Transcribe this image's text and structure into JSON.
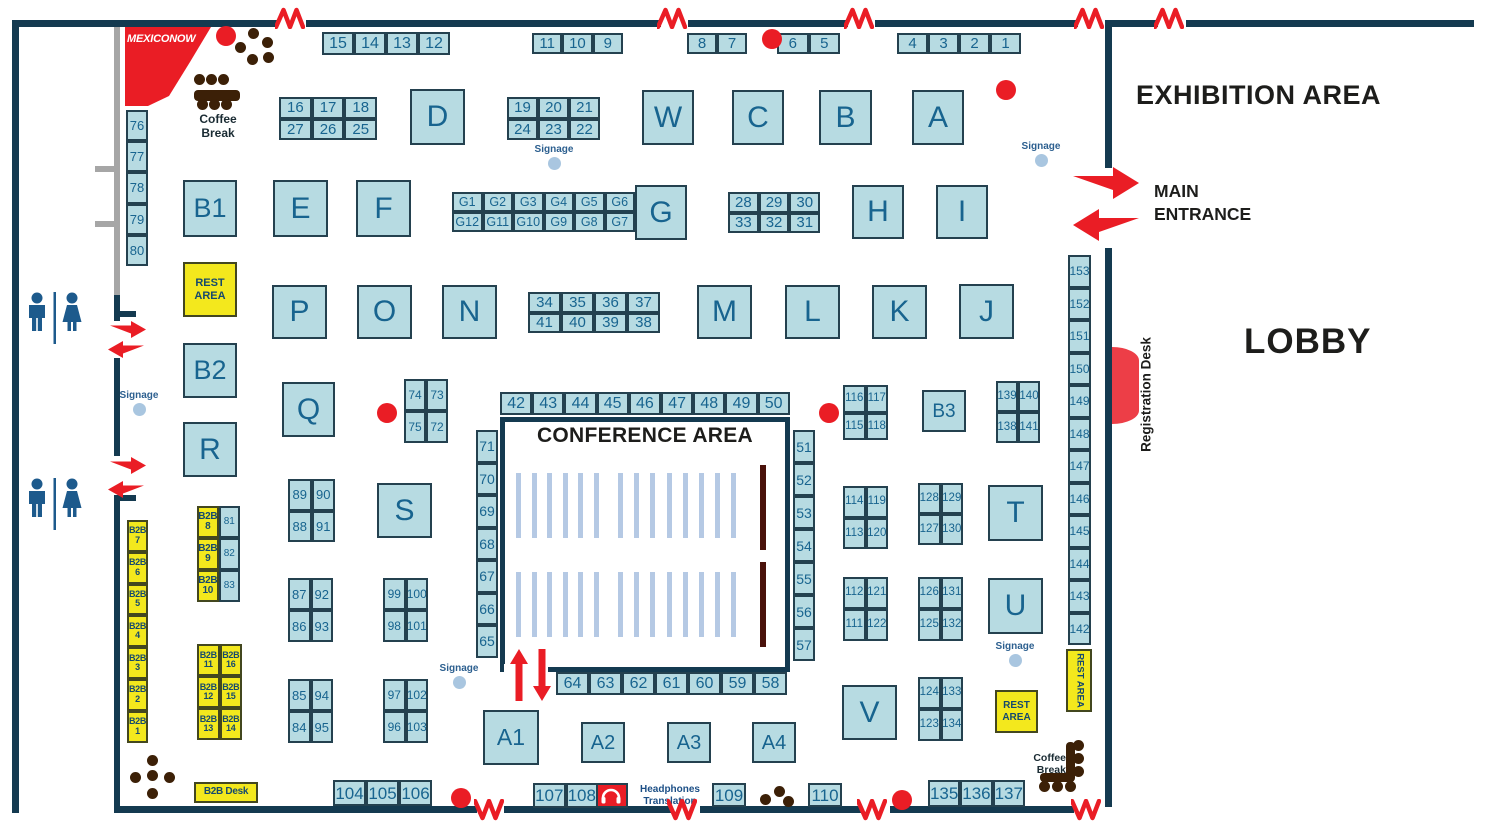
{
  "labels": {
    "logo": "MEXICONOW",
    "exhibition_area": "EXHIBITION AREA",
    "main_entrance": "MAIN\nENTRANCE",
    "lobby": "LOBBY",
    "conference_area": "CONFERENCE AREA",
    "registration_desk": "Registration Desk",
    "coffee_break": "Coffee\nBreak",
    "rest_area": "REST\nAREA",
    "rest_area_vertical": "REST AREA",
    "b2b_desk": "B2B Desk",
    "signage": "Signage",
    "headphones_translation": "Headphones\nTranslation"
  },
  "colors": {
    "booth_fill": "#b7dbe2",
    "booth_border": "#24414f",
    "booth_text": "#18648f",
    "yellow_fill": "#f3e81d",
    "wall": "#143a50",
    "red": "#ea1d25",
    "brown": "#3c2007",
    "seat": "#b5c9e4",
    "podium": "#4a120b",
    "signage_dot": "#a9c6e0",
    "gray": "#a6a6a6"
  },
  "booth_groups": {
    "strip_15_12": [
      "15",
      "14",
      "13",
      "12"
    ],
    "strip_11_9": [
      "11",
      "10",
      "9"
    ],
    "strip_8_7": [
      "8",
      "7"
    ],
    "strip_6_5": [
      "6",
      "5"
    ],
    "strip_4_1": [
      "4",
      "3",
      "2",
      "1"
    ],
    "block_16_25": [
      "16",
      "17",
      "18",
      "27",
      "26",
      "25"
    ],
    "block_19_22": [
      "19",
      "20",
      "21",
      "24",
      "23",
      "22"
    ],
    "block_g": [
      "G1",
      "G2",
      "G3",
      "G4",
      "G5",
      "G6",
      "G12",
      "G11",
      "G10",
      "G9",
      "G8",
      "G7"
    ],
    "block_28_31": [
      "28",
      "29",
      "30",
      "33",
      "32",
      "31"
    ],
    "block_34_38": [
      "34",
      "35",
      "36",
      "37",
      "41",
      "40",
      "39",
      "38"
    ],
    "col_76_80": [
      "76",
      "77",
      "78",
      "79",
      "80"
    ],
    "col_153_142": [
      "153",
      "152",
      "151",
      "150",
      "149",
      "148",
      "147",
      "146",
      "145",
      "144",
      "143",
      "142"
    ],
    "strip_42_50": [
      "42",
      "43",
      "44",
      "45",
      "46",
      "47",
      "48",
      "49",
      "50"
    ],
    "strip_64_58": [
      "64",
      "63",
      "62",
      "61",
      "60",
      "59",
      "58"
    ],
    "col_71_65": [
      "71",
      "70",
      "69",
      "68",
      "67",
      "66",
      "65"
    ],
    "col_51_57": [
      "51",
      "52",
      "53",
      "54",
      "55",
      "56",
      "57"
    ],
    "block_74_72": [
      "74",
      "73",
      "75",
      "72"
    ],
    "block_116_118": [
      "116",
      "117",
      "115",
      "118"
    ],
    "block_139_141": [
      "139",
      "140",
      "138",
      "141"
    ],
    "block_114_120": [
      "114",
      "119",
      "113",
      "120"
    ],
    "block_128_130": [
      "128",
      "129",
      "127",
      "130"
    ],
    "block_112_122": [
      "112",
      "121",
      "111",
      "122"
    ],
    "block_126_132": [
      "126",
      "131",
      "125",
      "132"
    ],
    "block_124_134": [
      "124",
      "133",
      "123",
      "134"
    ],
    "block_89_91": [
      "89",
      "90",
      "88",
      "91"
    ],
    "block_87_93": [
      "87",
      "92",
      "86",
      "93"
    ],
    "block_85_95": [
      "85",
      "94",
      "84",
      "95"
    ],
    "block_99_101": [
      "99",
      "100",
      "98",
      "101"
    ],
    "block_97_103": [
      "97",
      "102",
      "96",
      "103"
    ],
    "col_b2b": [
      "B2B 7",
      "B2B 6",
      "B2B 5",
      "B2B 4",
      "B2B 3",
      "B2B 2",
      "B2B 1"
    ],
    "pair_b2b_8_10": [
      "B2B 8",
      "81",
      "B2B 9",
      "82",
      "B2B 10",
      "83"
    ],
    "block_b2b_11_16": [
      "B2B 11",
      "B2B 16",
      "B2B 12",
      "B2B 15",
      "B2B 13",
      "B2B 14"
    ],
    "strip_104_106": [
      "104",
      "105",
      "106"
    ],
    "strip_107_108": [
      "107",
      "108"
    ],
    "strip_109": [
      "109"
    ],
    "strip_110": [
      "110"
    ],
    "strip_135_137": [
      "135",
      "136",
      "137"
    ]
  },
  "letter_booths": {
    "b1": "B1",
    "e": "E",
    "f": "F",
    "g": "G",
    "h": "H",
    "i": "I",
    "d": "D",
    "w": "W",
    "c": "C",
    "b": "B",
    "a": "A",
    "p": "P",
    "o": "O",
    "n": "N",
    "m": "M",
    "l": "L",
    "k": "K",
    "j": "J",
    "b2": "B2",
    "q": "Q",
    "r": "R",
    "s": "S",
    "t": "T",
    "u": "U",
    "v": "V",
    "a1": "A1",
    "a2": "A2",
    "a3": "A3",
    "a4": "A4",
    "b3": "B3"
  }
}
